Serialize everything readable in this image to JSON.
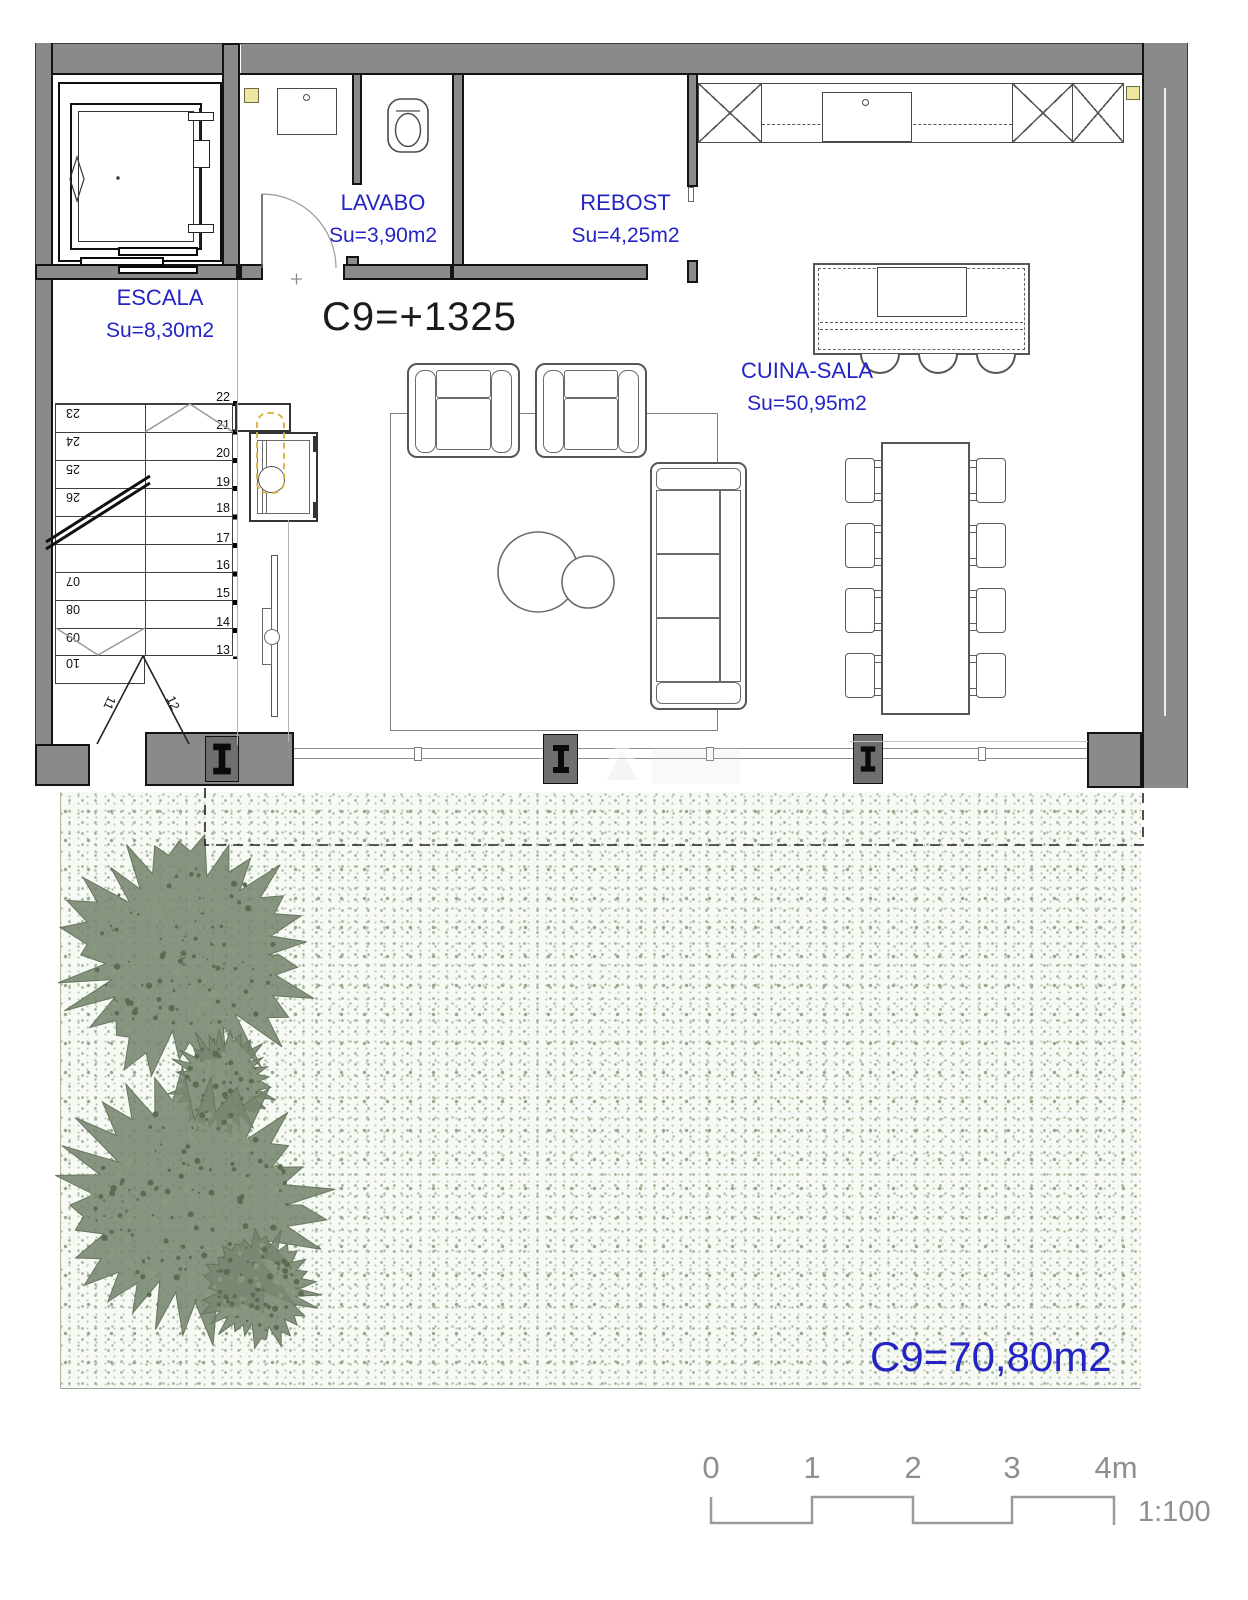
{
  "plan": {
    "level_mark": "C9=+1325",
    "terrace_label": "C9=70,80m2"
  },
  "rooms": [
    {
      "name": "ESCALA",
      "area": "Su=8,30m2"
    },
    {
      "name": "LAVABO",
      "area": "Su=3,90m2"
    },
    {
      "name": "REBOST",
      "area": "Su=4,25m2"
    },
    {
      "name": "CUINA-SALA",
      "area": "Su=50,95m2"
    }
  ],
  "stairs": {
    "left_numbers": [
      "23",
      "24",
      "25",
      "26",
      "07",
      "08",
      "09",
      "10"
    ],
    "right_numbers": [
      "22",
      "21",
      "20",
      "19",
      "18",
      "17",
      "16",
      "15",
      "14",
      "13"
    ],
    "diagonal_numbers": [
      "11",
      "12"
    ]
  },
  "scale_bar": {
    "ticks": [
      "0",
      "1",
      "2",
      "3",
      "4m"
    ],
    "ratio": "1:100"
  },
  "colors": {
    "label_blue": "#2424c4",
    "wall_gray": "#8a8a8a",
    "line_dark": "#141414",
    "tree_green": "#78866f",
    "speckle_green": "#a3b79b",
    "accent_yellow": "#efe6a0",
    "scale_gray": "#8f8f8f"
  }
}
